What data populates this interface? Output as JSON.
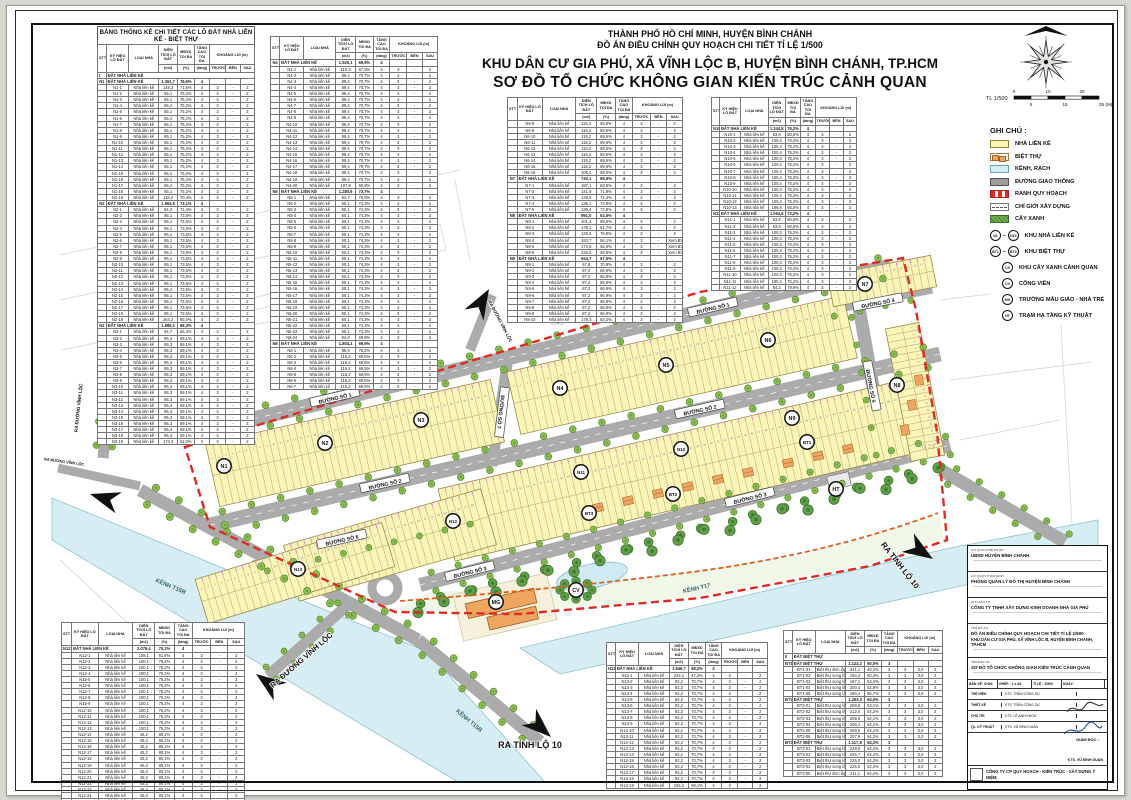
{
  "header": {
    "line1": "THÀNH PHỐ HỒ CHÍ MINH, HUYỆN BÌNH CHÁNH",
    "line2": "ĐỒ ÁN ĐIỀU CHỈNH QUY HOẠCH CHI TIẾT TỈ LỆ 1/500",
    "line3": "KHU DÂN CƯ GIA PHÚ, XÃ VĨNH LỘC B, HUYỆN BÌNH CHÁNH, TP.HCM",
    "line4": "SƠ ĐỒ TỔ CHỨC KHÔNG GIAN KIẾN TRÚC CẢNH QUAN"
  },
  "scale": {
    "note": "TL 1/500",
    "ticks_top": [
      "0",
      "10",
      "20"
    ],
    "ticks_bottom": [
      "5",
      "15",
      "25 (M)"
    ]
  },
  "table_headers": {
    "stt": "STT",
    "ky_hieu": "KÝ HIỆU LÔ ĐẤT",
    "loai_nha": "LOẠI NHÀ",
    "dien_tich": "DIỆN TÍCH LÔ ĐẤT",
    "dt_unit": "(m2)",
    "mdxd": "MĐXD TỐI ĐA",
    "md_unit": "(%)",
    "tang_cao": "TẦNG CAO TỐI ĐA",
    "tc_unit": "(tầng)",
    "khoang_lui": "KHOẢNG LÙI (m)",
    "truoc": "TRƯỚC",
    "ben": "BÊN",
    "sau": "SAU"
  },
  "row_defaults": {
    "lk": {
      "type": "Nhà liên kế",
      "floors": "4",
      "front": "3",
      "side": "-",
      "back": "2"
    },
    "bt": {
      "type": "Biệt thự song lập",
      "floors": "3",
      "front": "3",
      "side": "3,0",
      "back": "2"
    }
  },
  "tables": [
    {
      "host": "table-a",
      "title": "BẢNG THỐNG KÊ CHI TIẾT CÁC LÔ ĐẤT NHÀ LIÊN KẾ - BIỆT THỰ",
      "sections": [
        {
          "group": "I",
          "label": "ĐẤT NHÀ LIÊN KẾ"
        },
        {
          "no": "N1",
          "label": "ĐẤT NHÀ LIÊN KẾ",
          "area": "1.361,7",
          "density": "76,6%",
          "floors": "4",
          "rows": [
            [
              "N1-1",
              "149,3",
              "71,5%"
            ],
            [
              "N1-2..18",
              "65,1",
              "75,2%"
            ],
            [
              "N1-19",
              "118,2",
              "70,4%"
            ]
          ]
        },
        {
          "no": "N2",
          "label": "ĐẤT NHÀ LIÊN KẾ",
          "area": "1.864,9",
          "density": "73,1%",
          "floors": "4",
          "rows": [
            [
              "N2-1",
              "84,3",
              "71,4%"
            ],
            [
              "N2-2..18",
              "95,1",
              "73,5%"
            ],
            [
              "N2-19",
              "164,2",
              "65,0%"
            ]
          ]
        },
        {
          "no": "N3",
          "label": "ĐẤT NHÀ LIÊN KẾ",
          "area": "1.889,1",
          "density": "68,3%",
          "floors": "4",
          "rows": [
            [
              "N3-1",
              "94,7",
              "66,4%"
            ],
            [
              "N3-2..18",
              "95,3",
              "69,1%"
            ],
            [
              "N3-19",
              "174,3",
              "61,0%"
            ]
          ]
        }
      ]
    },
    {
      "host": "table-b",
      "sections": [
        {
          "no": "N4",
          "label": "ĐẤT NHÀ LIÊN KẾ",
          "area": "1.926,1",
          "density": "69,5%",
          "floors": "4",
          "rows": [
            [
              "N4-1",
              "119,3",
              "67,5%"
            ],
            [
              "N4-2..19",
              "89,4",
              "70,7%"
            ],
            [
              "N4-20",
              "197,9",
              "60,8%"
            ]
          ]
        },
        {
          "no": "N5",
          "label": "ĐẤT NHÀ LIÊN KẾ",
          "area": "1.280,9",
          "density": "73,7%",
          "floors": "4",
          "rows": [
            [
              "N5-1",
              "84,7",
              "70,9%"
            ],
            [
              "N5-2..23",
              "50,1",
              "74,3%"
            ],
            [
              "N5-24",
              "94,0",
              "69,8%"
            ]
          ]
        },
        {
          "no": "N6",
          "label": "ĐẤT NHÀ LIÊN KẾ",
          "area": "1.804,1",
          "density": "69,6%",
          "floors": "4",
          "rows": [
            [
              "N6-1",
              "85,9",
              "70,2%"
            ],
            [
              "N6-2..7",
              "115,2",
              "69,5%"
            ]
          ]
        }
      ]
    },
    {
      "host": "table-c",
      "sections": [
        {
          "cont": true,
          "rows": [
            [
              "N6-8..15",
              "115,2",
              "69,5%"
            ],
            [
              "N6-16",
              "105,4",
              "68,0%"
            ]
          ]
        },
        {
          "no": "N7",
          "label": "ĐẤT NHÀ LIÊN KẾ",
          "area": "740,1",
          "density": "69,5%",
          "floors": "4",
          "rows": [
            [
              "N7-1",
              "187,1",
              "63,5%"
            ],
            [
              "N7-2",
              "141,9",
              "71,8%"
            ],
            [
              "N7-3",
              "138,6",
              "72,4%"
            ],
            [
              "N7-4",
              "136,1",
              "72,9%"
            ],
            [
              "N7-5",
              "136,4",
              "72,8%"
            ]
          ]
        },
        {
          "no": "N8",
          "label": "ĐẤT NHÀ LIÊN KẾ",
          "area": "991,0",
          "density": "63,5%",
          "floors": "4",
          "rows": [
            [
              "N8-1",
              "101,3",
              "69,0%"
            ],
            [
              "N8-2",
              "178,1",
              "61,7%"
            ],
            [
              "N8-3",
              "128,5",
              "75,9%"
            ],
            [
              "N8-4",
              "183,7",
              "56,1%",
              "Xem BV"
            ],
            [
              "N8-5",
              "173,8",
              "55,6%",
              "Xem BV"
            ],
            [
              "N8-6",
              "225,6",
              "49,8%",
              "Xem BV"
            ]
          ]
        },
        {
          "no": "N9",
          "label": "ĐẤT NHÀ LIÊN KẾ",
          "area": "944,7",
          "density": "67,5%",
          "floors": "4",
          "rows": [
            [
              "N9-1",
              "67,8",
              "70,9%"
            ],
            [
              "N9-2..9",
              "87,2",
              "66,9%"
            ],
            [
              "N9-10",
              "179,3",
              "62,2%"
            ]
          ]
        }
      ]
    },
    {
      "host": "table-d",
      "sections": [
        {
          "no": "N10",
          "label": "ĐẤT NHÀ LIÊN KẾ",
          "area": "1.344,8",
          "density": "76,2%",
          "floors": "4",
          "rows": [
            [
              "N10-1",
              "53,8",
              "80,5%"
            ],
            [
              "N10-2..12",
              "100,4",
              "75,2%"
            ],
            [
              "N10-13",
              "186,6",
              "65,0%"
            ]
          ]
        },
        {
          "no": "N11",
          "label": "ĐẤT NHÀ LIÊN KẾ",
          "area": "1.064,6",
          "density": "73,2%",
          "floors": "4",
          "rows": [
            [
              "N11-1",
              "53,8",
              "80,5%"
            ],
            [
              "N11-2",
              "53,8",
              "80,5%"
            ],
            [
              "N11-3..11",
              "100,3",
              "75,2%"
            ],
            [
              "N11-12",
              "54,3",
              "79,9%"
            ]
          ]
        }
      ]
    },
    {
      "host": "table-e",
      "sections": [
        {
          "no": "N12",
          "label": "ĐẤT NHÀ LIÊN KẾ",
          "area": "2.076,4",
          "density": "70,1%",
          "floors": "4",
          "rows": [
            [
              "N12-1",
              "159,1",
              "61,8%"
            ],
            [
              "N12-2..13",
              "100,1",
              "75,2%"
            ],
            [
              "N12-14..24",
              "45,2",
              "80,1%"
            ],
            [
              "N12-25",
              "218,9",
              "58,7%"
            ]
          ]
        }
      ]
    },
    {
      "host": "table-f",
      "sections": [
        {
          "no": "N13",
          "label": "ĐẤT NHÀ LIÊN KẾ",
          "area": "1.946,7",
          "density": "68,2%",
          "floors": "4",
          "rows": [
            [
              "N13-1",
              "224,1",
              "47,2%"
            ],
            [
              "N13-2..18",
              "92,2",
              "70,7%"
            ],
            [
              "N13-19",
              "155,2",
              "60,1%"
            ]
          ]
        }
      ]
    },
    {
      "host": "table-g",
      "bt": true,
      "sections": [
        {
          "group": "II",
          "label": "ĐẤT BIỆT THỰ"
        },
        {
          "no": "BT1",
          "label": "ĐẤT BIỆT THỰ",
          "area": "1.123,2",
          "density": "50,0%",
          "floors": "3",
          "rows": [
            [
              "BT1-01",
              "341,1",
              "40,2%",
              "Biệt thự đơn lập"
            ],
            [
              "BT1-02",
              "194,2",
              "50,3%"
            ],
            [
              "BT1-03",
              "197,1",
              "53,4%"
            ],
            [
              "BT1-04",
              "200,4",
              "52,9%"
            ],
            [
              "BT1-05",
              "190,4",
              "55,7%"
            ]
          ]
        },
        {
          "no": "BT2",
          "label": "ĐẤT BIỆT THỰ",
          "area": "1.253,2",
          "density": "54,0%",
          "floors": "3",
          "rows": [
            [
              "BT2-01",
              "208,8",
              "53,1%"
            ],
            [
              "BT2-02",
              "212,4",
              "54,2%"
            ],
            [
              "BT2-03",
              "208,0",
              "54,1%"
            ],
            [
              "BT2-04",
              "208,1",
              "54,1%"
            ],
            [
              "BT2-05",
              "208,0",
              "54,1%"
            ],
            [
              "BT2-06",
              "207,9",
              "54,3%"
            ]
          ]
        },
        {
          "no": "BT3",
          "label": "ĐẤT BIỆT THỰ",
          "area": "1.117,8",
          "density": "54,2%",
          "floors": "3",
          "rows": [
            [
              "BT3-01",
              "228,0",
              "54,2%"
            ],
            [
              "BT3-02",
              "226,7",
              "54,2%"
            ],
            [
              "BT3-03",
              "226,0",
              "54,2%"
            ],
            [
              "BT3-04",
              "226,0",
              "54,2%"
            ],
            [
              "BT3-05",
              "211,1",
              "54,2%",
              "Biệt thự đơn lập"
            ]
          ]
        }
      ]
    }
  ],
  "legend": {
    "title": "GHI CHÚ :",
    "swatches": [
      {
        "key": "lienke",
        "label": "NHÀ LIÊN KẾ"
      },
      {
        "key": "bietthu",
        "label": "BIỆT THỰ"
      },
      {
        "key": "kenh",
        "label": "KÊNH, RẠCH"
      },
      {
        "key": "duong",
        "label": "ĐƯỜNG GIAO THÔNG"
      },
      {
        "key": "ranh",
        "label": "RANH QUY HOẠCH"
      },
      {
        "key": "chigioi",
        "label": "CHỈ GIỚI XÂY DỰNG"
      },
      {
        "key": "cayxanh",
        "label": "CÂY XANH"
      }
    ],
    "badges": [
      {
        "from": "N1",
        "to": "N13",
        "label": "KHU NHÀ LIÊN KẾ"
      },
      {
        "from": "BT1",
        "to": "BT3",
        "label": "KHU BIỆT THỰ"
      },
      {
        "code": "CX",
        "label": "KHU CÂY XANH CẢNH QUAN"
      },
      {
        "code": "CV",
        "label": "CÔNG VIÊN"
      },
      {
        "code": "MG",
        "label": "TRƯỜNG MẪU GIÁO - NHÀ TRẺ"
      },
      {
        "code": "HT",
        "label": "TRẠM HẠ TẦNG KỸ THUẬT"
      }
    ]
  },
  "map": {
    "street_labels": [
      {
        "id": "d1a",
        "text": "ĐƯỜNG SỐ 1"
      },
      {
        "id": "d1b",
        "text": "ĐƯỜNG SỐ 1"
      },
      {
        "id": "d2a",
        "text": "ĐƯỜNG SỐ 2"
      },
      {
        "id": "d2b",
        "text": "ĐƯỜNG SỐ 2"
      },
      {
        "id": "d3a",
        "text": "ĐƯỜNG SỐ 3"
      },
      {
        "id": "d3b",
        "text": "ĐƯỜNG SỐ 3"
      },
      {
        "id": "d4",
        "text": "ĐƯỜNG SỐ 4"
      },
      {
        "id": "d5",
        "text": "ĐƯỜNG SỐ 5"
      },
      {
        "id": "d6",
        "text": "ĐƯỜNG SỐ 6"
      },
      {
        "id": "d7",
        "text": "ĐƯỜNG SỐ 7"
      }
    ],
    "exit_labels": [
      {
        "id": "e1",
        "text": "RA ĐƯỜNG VĨNH LỘC"
      },
      {
        "id": "e2",
        "text": "RA ĐƯỜNG VĨNH LỘC"
      },
      {
        "id": "e3",
        "text": "RA ĐƯỜNG VĨNH LỘC"
      },
      {
        "id": "e4",
        "text": "RA TỈNH LỘ 10"
      },
      {
        "id": "e5",
        "text": "RA TỈNH LỘ 10"
      },
      {
        "id": "e6",
        "text": "RA ĐƯỜNG VĨNH LỘC"
      }
    ],
    "canal_labels": [
      {
        "id": "c1",
        "text": "KÊNH T15B"
      },
      {
        "id": "c2",
        "text": "KÊNH T15B"
      },
      {
        "id": "c3",
        "text": "KÊNH T17"
      }
    ],
    "nodes": [
      "N1",
      "N2",
      "N3",
      "N4",
      "N5",
      "N6",
      "N7",
      "N8",
      "N9",
      "N10",
      "N11",
      "N12",
      "N13",
      "BT1",
      "BT2",
      "BT3",
      "MG",
      "CV",
      "HT"
    ],
    "background_numbers": [
      {
        "id": "b1",
        "text": "0,24"
      },
      {
        "id": "b2",
        "text": "0,45"
      },
      {
        "id": "b3",
        "text": "0,68"
      },
      {
        "id": "b4",
        "text": "0,51"
      },
      {
        "id": "b5",
        "text": "0,46"
      },
      {
        "id": "b6",
        "text": "0,45"
      },
      {
        "id": "b7",
        "text": "0,73"
      }
    ]
  },
  "title_block": {
    "rows": [
      {
        "label": "CƠ QUAN PHÊ DUYỆT",
        "value": "UBND HUYỆN BÌNH CHÁNH"
      },
      {
        "label": "CƠ QUAN THẨM ĐỊNH",
        "value": "PHÒNG QUẢN LÝ ĐÔ THỊ HUYỆN BÌNH CHÁNH"
      },
      {
        "label": "CHỦ ĐẦU TƯ",
        "value": "CÔNG TY TNHH XÂY DỰNG KINH DOANH NHÀ GIA PHÚ"
      },
      {
        "label": "TÊN ĐỒ ÁN",
        "value": "ĐỒ ÁN ĐIỀU CHỈNH QUY HOẠCH CHI TIẾT TỈ LỆ 1/500",
        "value2": "KHU DÂN CƯ GIA PHÚ, XÃ VĨNH LỘC B, HUYỆN BÌNH CHÁNH, TP.HCM"
      },
      {
        "label": "TÊN BẢN VẼ",
        "value": "SƠ ĐỒ TỔ CHỨC KHÔNG GIAN KIẾN TRÚC CẢNH QUAN"
      }
    ],
    "info": [
      "BẢN VẼ: CH04",
      "GHÉP : 1 x A0",
      "TỈ LỆ : 1/500",
      "NGÀY:"
    ],
    "staff": [
      [
        "THỂ HIỆN",
        "KTS. TRẦN CÔNG SỰ"
      ],
      [
        "THIẾT KẾ",
        "KTS. TRẦN CÔNG SỰ"
      ],
      [
        "CHỦ TRÌ",
        "KTS. LÊ ANH KHOA"
      ],
      [
        "QL. KỸ THUẬT",
        "KTS. VŨ ĐÌNH DUẨN"
      ]
    ],
    "director_label": "GIÁM ĐỐC :",
    "director_name": "KTS. VŨ ĐÌNH DUẨN",
    "company": "CÔNG TY CP QUY HOẠCH - KIẾN TRÚC - XÂY DỰNG Ý NIỆM"
  },
  "colors": {
    "lot_yellow": "#fbf5b8",
    "road_gray": "#ababab",
    "water_blue": "#d6eef3",
    "tree_green": "#8cc152",
    "park_green": "#5fa049",
    "boundary_red": "#e02b20",
    "build_limit_orange": "#e05f1e",
    "villa_orange": "#eda55f"
  }
}
